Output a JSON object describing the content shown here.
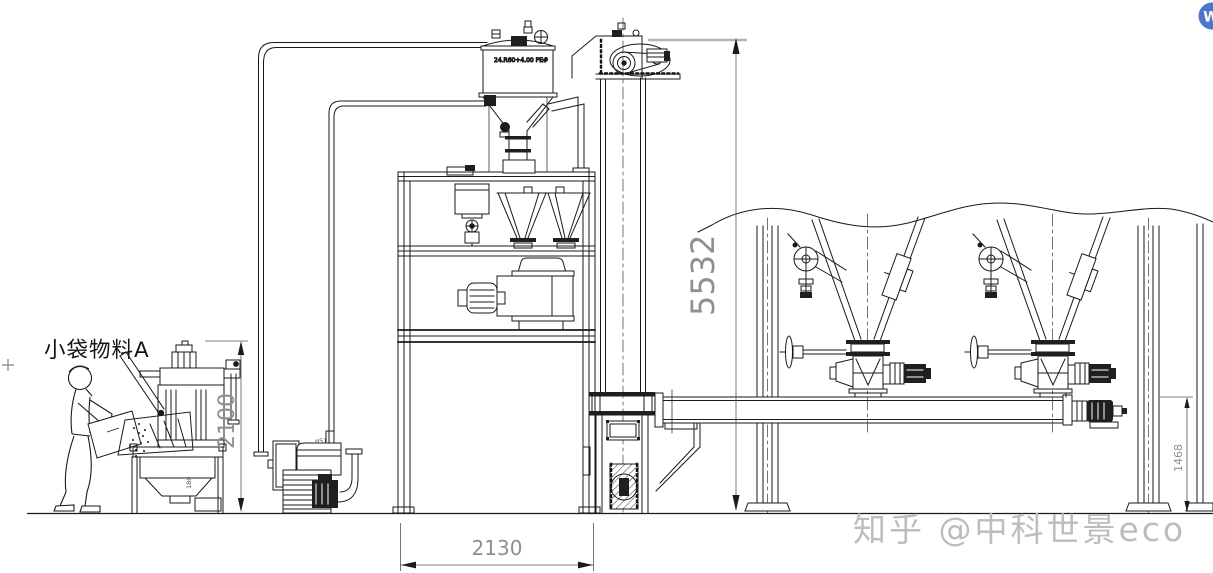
{
  "drawing": {
    "material_label": "小袋物料A",
    "receiver_note": "24.R60+4.00 PE#",
    "pipe_note": "ø51",
    "station_note": "180",
    "dimensions": {
      "overall_height": "5532",
      "dump_station_height": "2100",
      "platform_width": "2130",
      "discharge_height": "1468"
    },
    "watermark": "知乎 @中科世景eco",
    "badge_label": "W",
    "colors": {
      "line": "#1a1a1a",
      "dim_text": "#8f8f8f",
      "watermark": "#bdbdbd",
      "badge_blue": "#4a77c9"
    }
  }
}
